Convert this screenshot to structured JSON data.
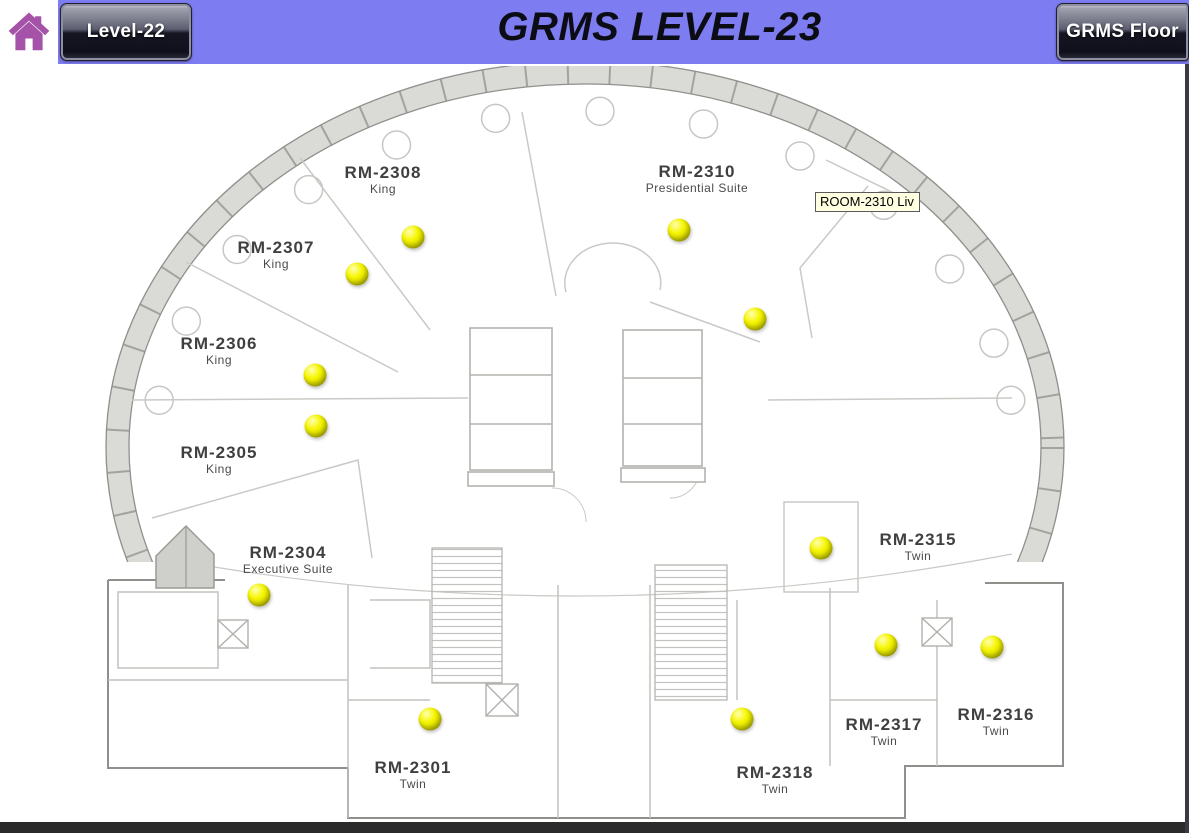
{
  "header": {
    "title": "GRMS LEVEL-23",
    "left_button": "Level-22",
    "right_button": "GRMS Floor",
    "band_color": "#7d7cf1",
    "home_icon": "home-icon",
    "home_icon_color": "#a553a8"
  },
  "tooltip": {
    "text": "ROOM-2310 Liv",
    "x": 815,
    "y": 192
  },
  "floor_plan": {
    "level_name": "LEVEL-23",
    "rooms": [
      {
        "id": "RM-2308",
        "type": "King",
        "x": 383,
        "y": 163
      },
      {
        "id": "RM-2307",
        "type": "King",
        "x": 276,
        "y": 238
      },
      {
        "id": "RM-2306",
        "type": "King",
        "x": 219,
        "y": 334
      },
      {
        "id": "RM-2305",
        "type": "King",
        "x": 219,
        "y": 443
      },
      {
        "id": "RM-2304",
        "type": "Executive Suite",
        "x": 288,
        "y": 543
      },
      {
        "id": "RM-2310",
        "type": "Presidential Suite",
        "x": 697,
        "y": 162
      },
      {
        "id": "RM-2315",
        "type": "Twin",
        "x": 918,
        "y": 530
      },
      {
        "id": "RM-2317",
        "type": "Twin",
        "x": 884,
        "y": 715
      },
      {
        "id": "RM-2316",
        "type": "Twin",
        "x": 996,
        "y": 705
      },
      {
        "id": "RM-2301",
        "type": "Twin",
        "x": 413,
        "y": 758
      },
      {
        "id": "RM-2318",
        "type": "Twin",
        "x": 775,
        "y": 763
      }
    ],
    "indicators": [
      {
        "room": "RM-2308",
        "x": 413,
        "y": 237
      },
      {
        "room": "RM-2307",
        "x": 357,
        "y": 274
      },
      {
        "room": "RM-2310",
        "x": 679,
        "y": 230
      },
      {
        "room": "RM-2310 Liv",
        "x": 755,
        "y": 319
      },
      {
        "room": "RM-2306",
        "x": 315,
        "y": 375
      },
      {
        "room": "RM-2305",
        "x": 316,
        "y": 426
      },
      {
        "room": "RM-2304",
        "x": 259,
        "y": 595
      },
      {
        "room": "RM-2315",
        "x": 821,
        "y": 548
      },
      {
        "room": "RM-2317",
        "x": 886,
        "y": 645
      },
      {
        "room": "RM-2316",
        "x": 992,
        "y": 647
      },
      {
        "room": "RM-2301",
        "x": 430,
        "y": 719
      },
      {
        "room": "RM-2318",
        "x": 742,
        "y": 719
      }
    ],
    "indicator_color": "#f0f000"
  },
  "footer": {
    "bar_color": "#2b2b2b"
  }
}
